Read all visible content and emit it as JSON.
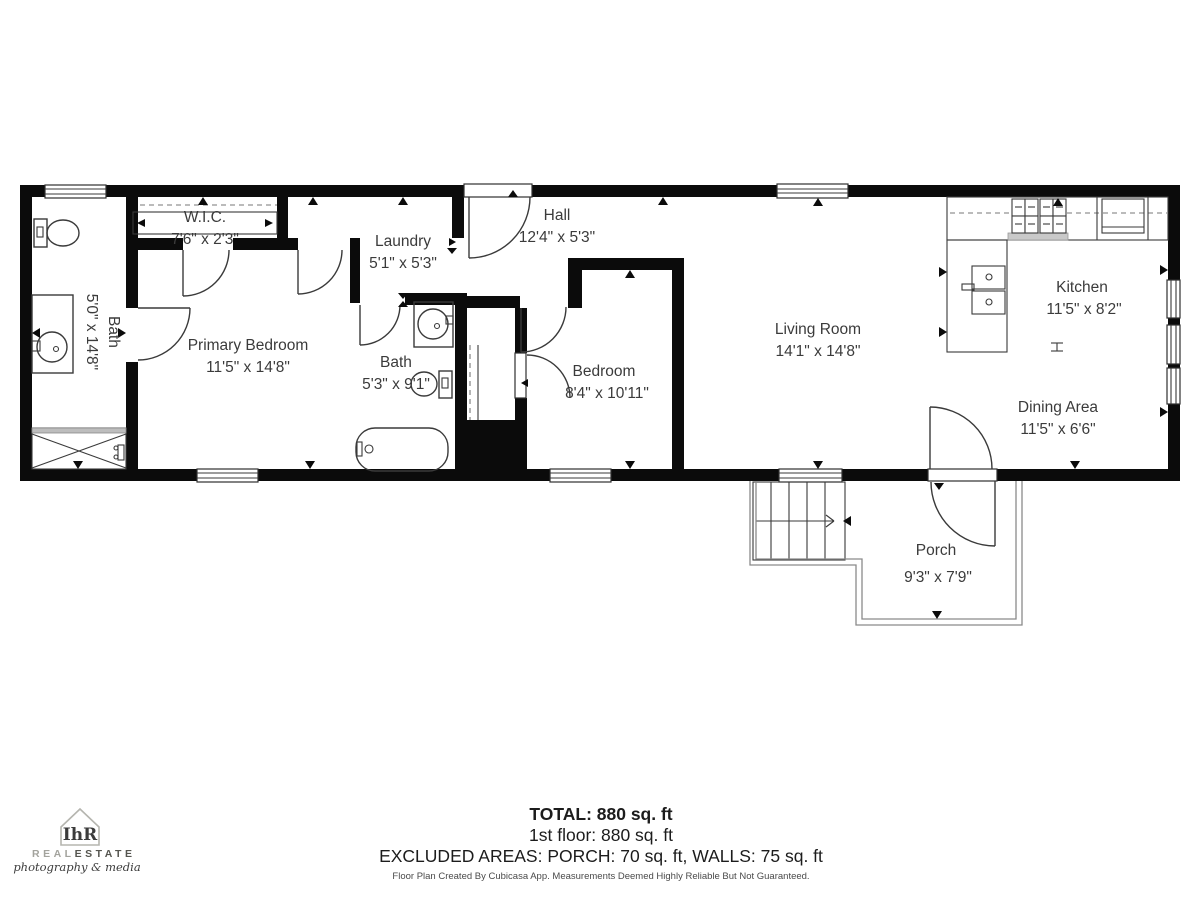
{
  "rooms": [
    {
      "name": "Bath",
      "dims": "5'0\" x 14'8\""
    },
    {
      "name": "W.I.C.",
      "dims": "7'6\" x 2'3\""
    },
    {
      "name": "Primary Bedroom",
      "dims": "11'5\" x 14'8\""
    },
    {
      "name": "Laundry",
      "dims": "5'1\" x 5'3\""
    },
    {
      "name": "Hall",
      "dims": "12'4\" x 5'3\""
    },
    {
      "name": "Bath",
      "dims": "5'3\" x 9'1\""
    },
    {
      "name": "Bedroom",
      "dims": "8'4\" x 10'11\""
    },
    {
      "name": "Living Room",
      "dims": "14'1\" x 14'8\""
    },
    {
      "name": "Kitchen",
      "dims": "11'5\" x 8'2\""
    },
    {
      "name": "Dining Area",
      "dims": "11'5\" x 6'6\""
    },
    {
      "name": "Porch",
      "dims": "9'3\" x 7'9\""
    }
  ],
  "summary": {
    "total": "TOTAL: 880 sq. ft",
    "floor": "1st floor: 880 sq. ft",
    "excluded": "EXCLUDED AREAS: PORCH: 70 sq. ft, WALLS: 75 sq. ft",
    "disclaimer": "Floor Plan Created By Cubicasa App. Measurements Deemed Highly Reliable But Not Guaranteed."
  },
  "logo": {
    "monogram": "IhR",
    "brand_light": "REAL",
    "brand_dark": "ESTATE",
    "tagline": "photography & media"
  },
  "colors": {
    "wall": "#0b0b0b",
    "fixture": "#3a3a3a",
    "label": "#3b3b3b",
    "logo_green": "#6d8a50",
    "logo_light_gray": "#a3a39d",
    "logo_dark_gray": "#55554f"
  }
}
